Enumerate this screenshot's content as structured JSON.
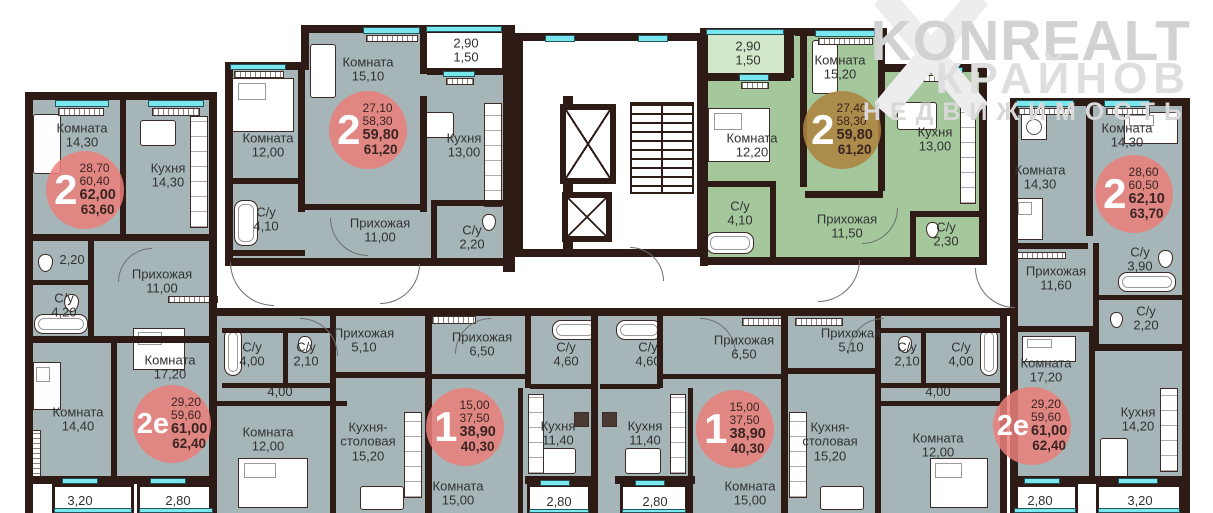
{
  "watermark": {
    "line1": "KONREALT",
    "line2": "КРАЙНОВ",
    "line3": "НЕДВИЖИМОСТЬ"
  },
  "colors": {
    "apartment_fill": "#a6b6b8",
    "highlighted_apartment_fill": "#a4c89c",
    "wall": "#2e1b16",
    "window_glass": "#79e8ee",
    "badge_red": "#ea7f7a",
    "badge_on_green": "#ad8340",
    "badge_number": "#ffffff",
    "badge_values_text": "#3b2421"
  },
  "badges": [
    {
      "type": "2",
      "values": [
        "28,70",
        "60,40",
        "62,00",
        "63,60"
      ]
    },
    {
      "type": "2",
      "values": [
        "27,10",
        "58,30",
        "59,80",
        "61,20"
      ]
    },
    {
      "type": "2",
      "values": [
        "27,40",
        "58,30",
        "59,80",
        "61,20"
      ]
    },
    {
      "type": "2",
      "values": [
        "28,60",
        "60,50",
        "62,10",
        "63,70"
      ]
    },
    {
      "type": "2е",
      "values": [
        "29,20",
        "59,60",
        "61,00",
        "62,40"
      ]
    },
    {
      "type": "1",
      "values": [
        "15,00",
        "37,50",
        "38,90",
        "40,30"
      ]
    },
    {
      "type": "1",
      "values": [
        "15,00",
        "37,50",
        "38,90",
        "40,30"
      ]
    },
    {
      "type": "2е",
      "values": [
        "29,20",
        "59,60",
        "61,00",
        "62,40"
      ]
    }
  ],
  "rooms": [
    {
      "name": "Комната",
      "area": "14,30",
      "x": 82,
      "y": 136
    },
    {
      "name": "Кухня",
      "area": "14,30",
      "x": 168,
      "y": 176
    },
    {
      "name": "",
      "area": "2,20",
      "x": 72,
      "y": 260
    },
    {
      "name": "Прихожая",
      "area": "11,00",
      "x": 162,
      "y": 282
    },
    {
      "name": "С/у",
      "area": "4,20",
      "x": 64,
      "y": 306
    },
    {
      "name": "Комната",
      "area": "17,20",
      "x": 170,
      "y": 368
    },
    {
      "name": "Комната",
      "area": "14,40",
      "x": 78,
      "y": 420
    },
    {
      "name": "",
      "area": "3,20",
      "x": 80,
      "y": 501
    },
    {
      "name": "",
      "area": "2,80",
      "x": 178,
      "y": 501
    },
    {
      "name": "Комната",
      "area": "12,00",
      "x": 268,
      "y": 146
    },
    {
      "name": "Комната",
      "area": "15,10",
      "x": 368,
      "y": 70
    },
    {
      "name": "2,90",
      "area": "1,50",
      "x": 466,
      "y": 51
    },
    {
      "name": "Кухня",
      "area": "13,00",
      "x": 464,
      "y": 146
    },
    {
      "name": "С/у",
      "area": "4,10",
      "x": 266,
      "y": 220
    },
    {
      "name": "Прихожая",
      "area": "11,00",
      "x": 380,
      "y": 231
    },
    {
      "name": "С/у",
      "area": "2,20",
      "x": 472,
      "y": 238
    },
    {
      "name": "2,90",
      "area": "1,50",
      "x": 748,
      "y": 54
    },
    {
      "name": "Комната",
      "area": "15,20",
      "x": 840,
      "y": 68
    },
    {
      "name": "Комната",
      "area": "12,20",
      "x": 752,
      "y": 146
    },
    {
      "name": "Кухня",
      "area": "13,00",
      "x": 935,
      "y": 140
    },
    {
      "name": "С/у",
      "area": "4,10",
      "x": 740,
      "y": 214
    },
    {
      "name": "Прихожая",
      "area": "11,50",
      "x": 847,
      "y": 227
    },
    {
      "name": "С/у",
      "area": "2,30",
      "x": 946,
      "y": 235
    },
    {
      "name": "Комната",
      "area": "14,30",
      "x": 1040,
      "y": 178
    },
    {
      "name": "Комната",
      "area": "14,30",
      "x": 1127,
      "y": 136
    },
    {
      "name": "Прихожая",
      "area": "11,60",
      "x": 1056,
      "y": 279
    },
    {
      "name": "С/у",
      "area": "3,90",
      "x": 1140,
      "y": 260
    },
    {
      "name": "С/у",
      "area": "2,20",
      "x": 1146,
      "y": 319
    },
    {
      "name": "Комната",
      "area": "17,20",
      "x": 1046,
      "y": 371
    },
    {
      "name": "Кухня",
      "area": "14,20",
      "x": 1138,
      "y": 420
    },
    {
      "name": "",
      "area": "2,80",
      "x": 1040,
      "y": 501
    },
    {
      "name": "",
      "area": "3,20",
      "x": 1140,
      "y": 501
    },
    {
      "name": "С/у",
      "area": "4,00",
      "x": 252,
      "y": 355
    },
    {
      "name": "С/у",
      "area": "2,10",
      "x": 306,
      "y": 355
    },
    {
      "name": "",
      "area": "4,00",
      "x": 280,
      "y": 392
    },
    {
      "name": "Прихожая",
      "area": "5,10",
      "x": 364,
      "y": 341
    },
    {
      "name": "Комната",
      "area": "12,00",
      "x": 268,
      "y": 440
    },
    {
      "name": "Кухня-столовая",
      "area": "15,20",
      "x": 368,
      "y": 442,
      "wrap": true
    },
    {
      "name": "Прихожая",
      "area": "6,50",
      "x": 482,
      "y": 345
    },
    {
      "name": "С/у",
      "area": "4,60",
      "x": 566,
      "y": 355
    },
    {
      "name": "С/у",
      "area": "4,60",
      "x": 648,
      "y": 355
    },
    {
      "name": "Кухня",
      "area": "11,40",
      "x": 558,
      "y": 434
    },
    {
      "name": "Кухня",
      "area": "11,40",
      "x": 645,
      "y": 434
    },
    {
      "name": "Комната",
      "area": "15,00",
      "x": 458,
      "y": 494
    },
    {
      "name": "Комната",
      "area": "15,00",
      "x": 750,
      "y": 494
    },
    {
      "name": "",
      "area": "2,80",
      "x": 559,
      "y": 502
    },
    {
      "name": "",
      "area": "2,80",
      "x": 655,
      "y": 502
    },
    {
      "name": "Прихожая",
      "area": "6,50",
      "x": 744,
      "y": 348
    },
    {
      "name": "Прихожая",
      "area": "5,10",
      "x": 851,
      "y": 341
    },
    {
      "name": "С/у",
      "area": "2,10",
      "x": 907,
      "y": 355
    },
    {
      "name": "С/у",
      "area": "4,00",
      "x": 961,
      "y": 355
    },
    {
      "name": "",
      "area": "4,00",
      "x": 938,
      "y": 392
    },
    {
      "name": "Кухня-столовая",
      "area": "15,20",
      "x": 830,
      "y": 442,
      "wrap": true
    },
    {
      "name": "Комната",
      "area": "12,00",
      "x": 938,
      "y": 446
    }
  ]
}
